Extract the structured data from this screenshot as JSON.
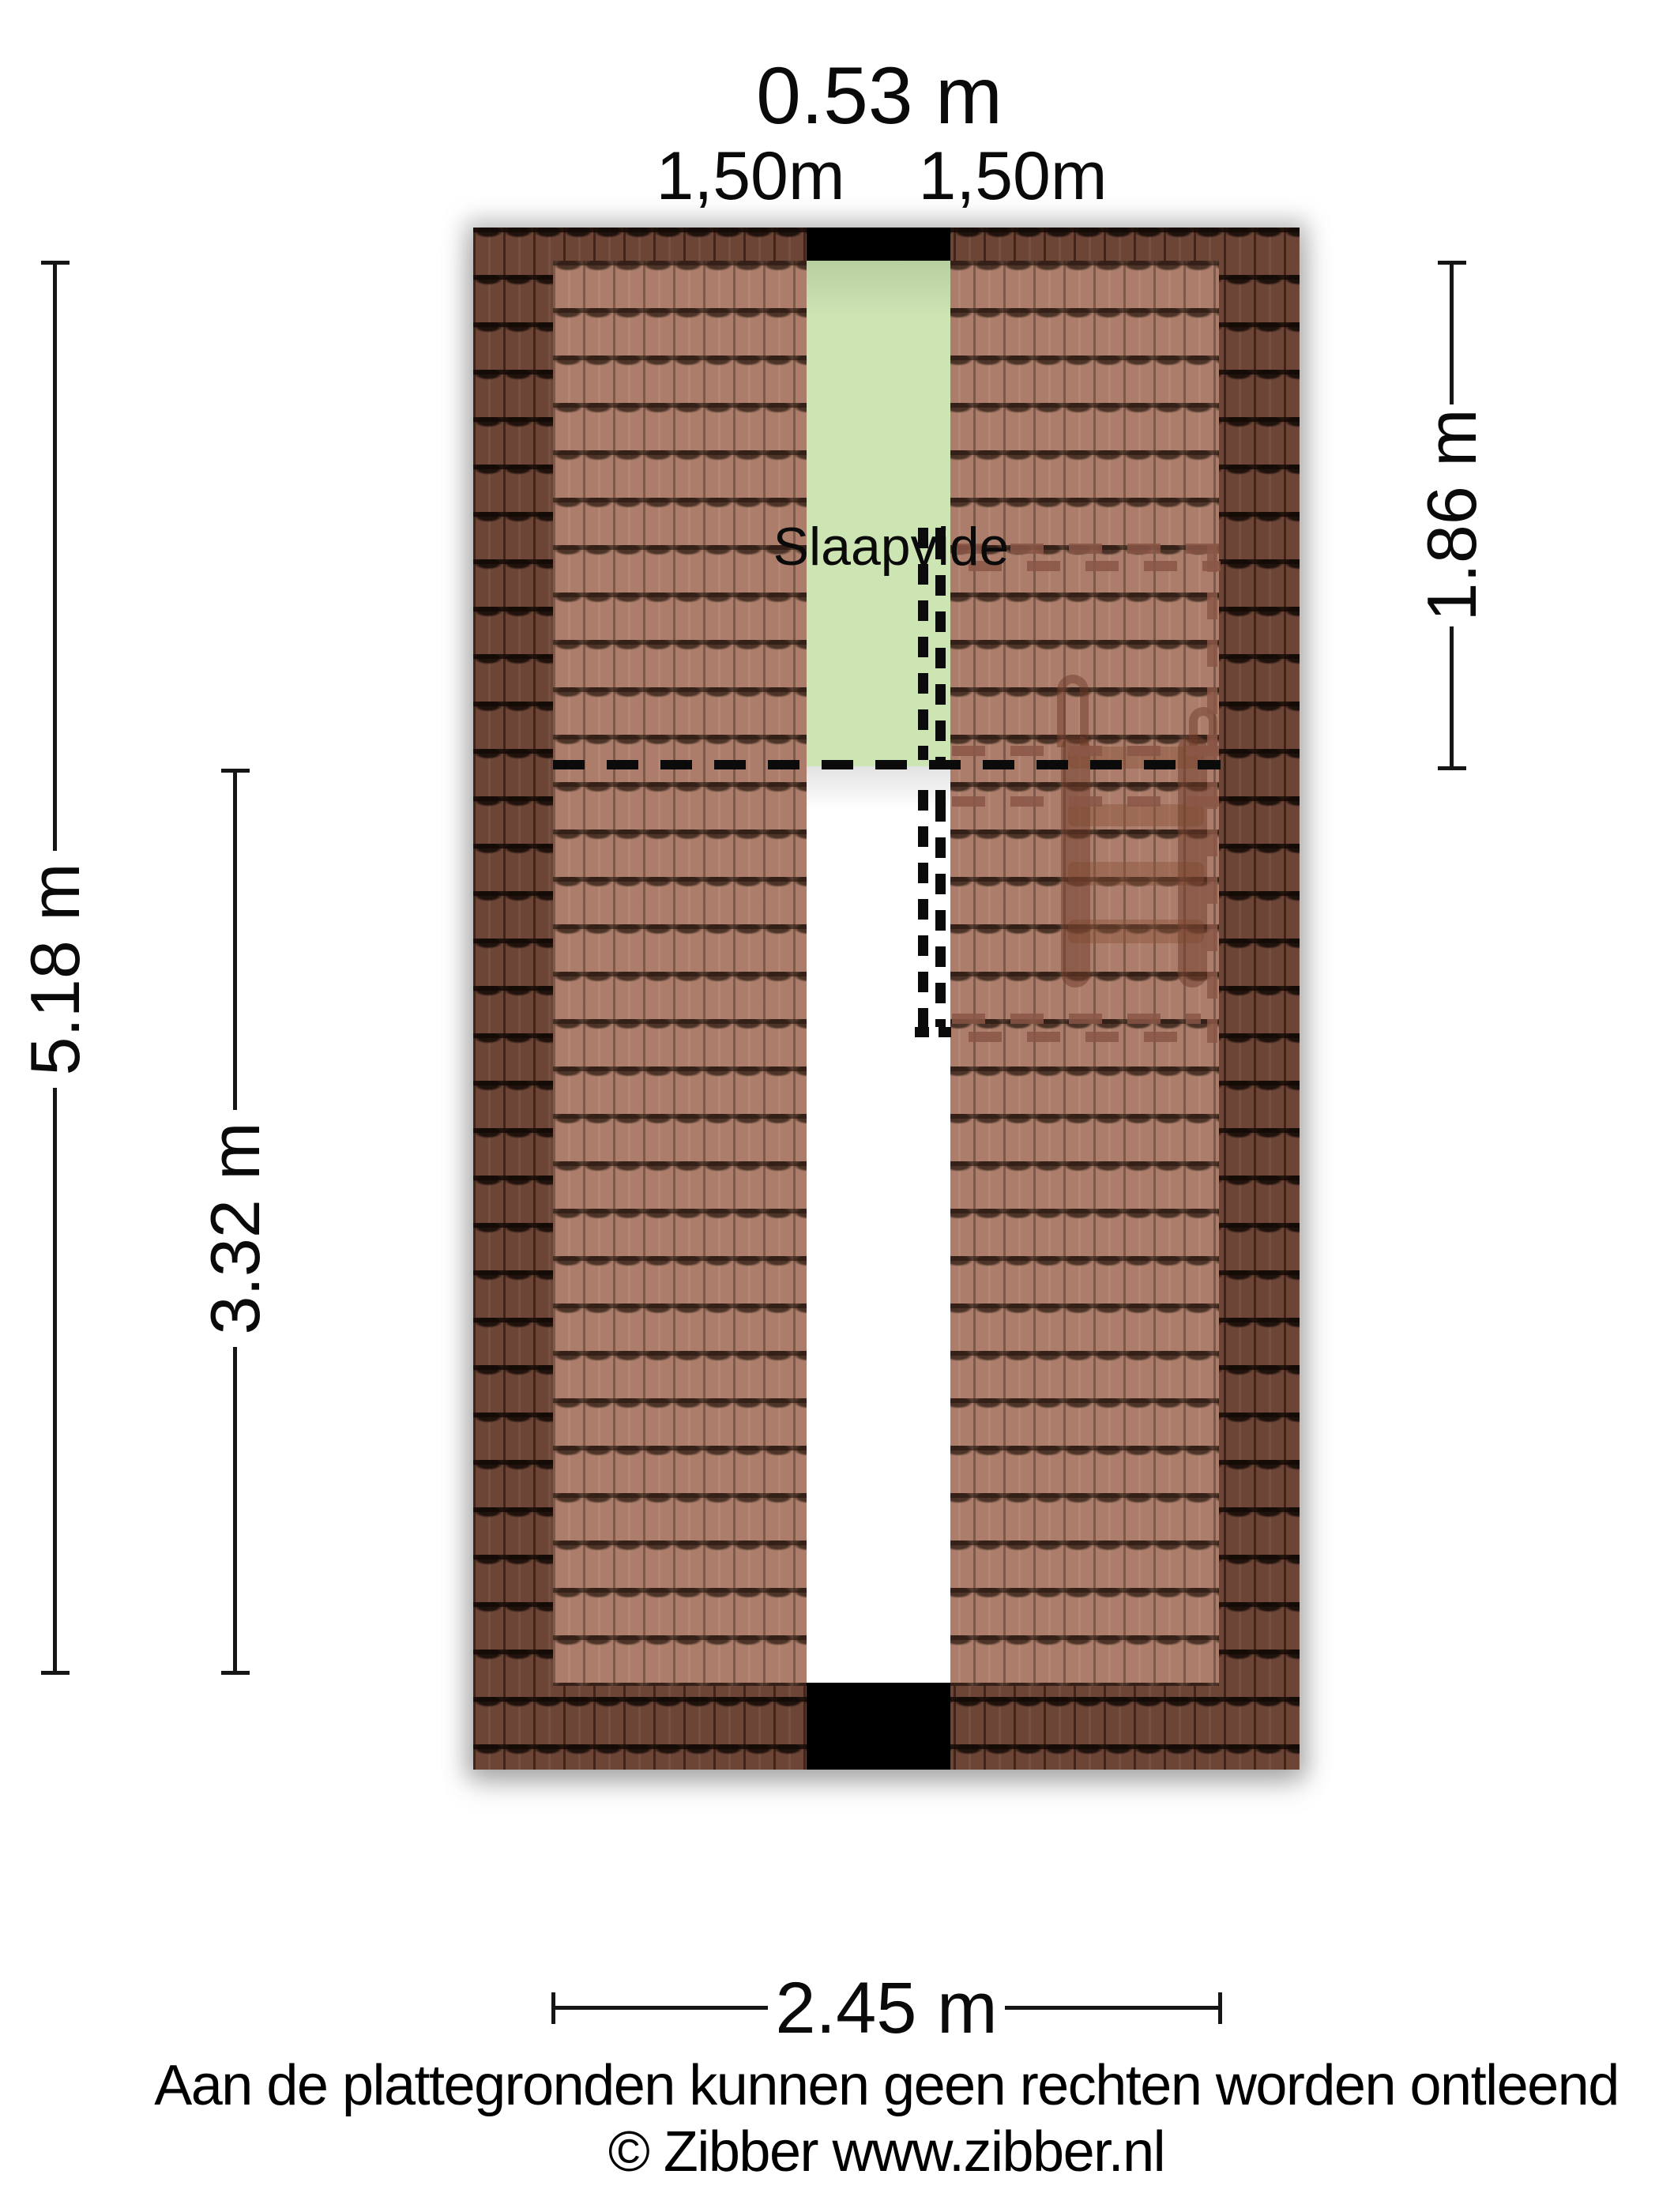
{
  "plan": {
    "title_dimension": "0.53 m",
    "upper_left_dimension": "1,50m",
    "upper_right_dimension": "1,50m",
    "room_label": "Slaapvide",
    "left_outer_dimension": "5.18 m",
    "left_inner_dimension": "3.32 m",
    "right_dimension": "1.86 m",
    "bottom_dimension": "2.45 m"
  },
  "footer": {
    "disclaimer": "Aan de plattegronden kunnen geen rechten worden ontleend",
    "copyright": "© Zibber www.zibber.nl"
  },
  "colors": {
    "roof_tile_dark": "#6d4537",
    "roof_tile_light": "#ab7d6a",
    "loft_green": "#cde4b3",
    "vide_white": "#ffffff",
    "ridge_black": "#000000",
    "dash_black": "#0b0b0b",
    "dash_brown": "#8a5646",
    "dimension_line": "#161616"
  }
}
